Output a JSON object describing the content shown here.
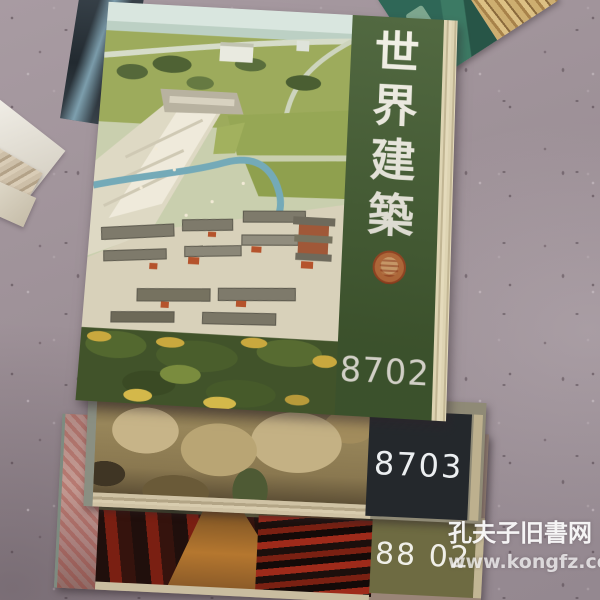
{
  "magazines": {
    "top": {
      "title_vertical": "世界建築",
      "title_chars": [
        "世",
        "界",
        "建",
        "築"
      ],
      "issue_number": "8702",
      "strip_color": "#455e33",
      "text_color": "#f3f1e6",
      "seal_icon": "red-circular-seal"
    },
    "middle": {
      "issue_number": "8703",
      "panel_color": "#24282c",
      "text_color": "#eceff1"
    },
    "bottom": {
      "issue_number": "88 02",
      "panel_color": "#6e6b42",
      "text_color": "#f0efe8"
    }
  },
  "watermark": {
    "site_name": "孔夫子旧書网",
    "site_url": "www.kongfz.com",
    "color": "#ffffff"
  }
}
